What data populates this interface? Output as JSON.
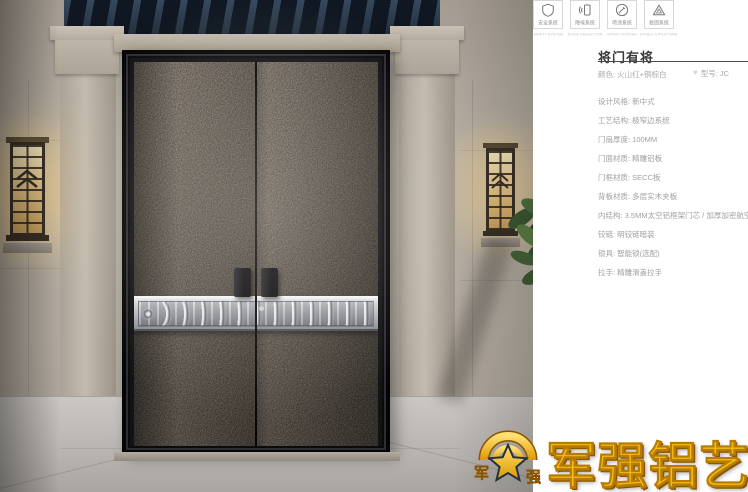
{
  "panel": {
    "title": "将门有将",
    "color": "颜色: 火山红+铜棕白",
    "model": "型号: JC",
    "specs": [
      "设计风格: 新中式",
      "工艺结构: 极窄边系统",
      "门扇厚度: 100MM",
      "门面材质: 精雕铝板",
      "门框材质: SECC板",
      "背板材质: 多层实木夹板",
      "内结构: 3.5MM太空铝框架门芯 / 加厚加密航空铝板",
      "铰链: 明铰链暗装",
      "锁具: 智能锁(选配)",
      "拉手: 精雕滑盖拉手"
    ],
    "features": [
      {
        "label": "安全系统",
        "caption": "SAFETY SYSTEM"
      },
      {
        "label": "降噪系统",
        "caption": "NOISE REDUCTION"
      },
      {
        "label": "喷涂系统",
        "caption": "SPRAY COATING"
      },
      {
        "label": "稳固系统",
        "caption": "STABLE STRUCTURE"
      }
    ]
  },
  "logo": {
    "text": "军强铝艺",
    "left_char": "军",
    "right_char": "强"
  },
  "colors": {
    "gold": "#f6bc16",
    "band_silver": "#c9cbd0",
    "door_bronze": "#3f352b",
    "eaves_navy": "#1a2633",
    "wall_stone": "#b3aba0"
  }
}
